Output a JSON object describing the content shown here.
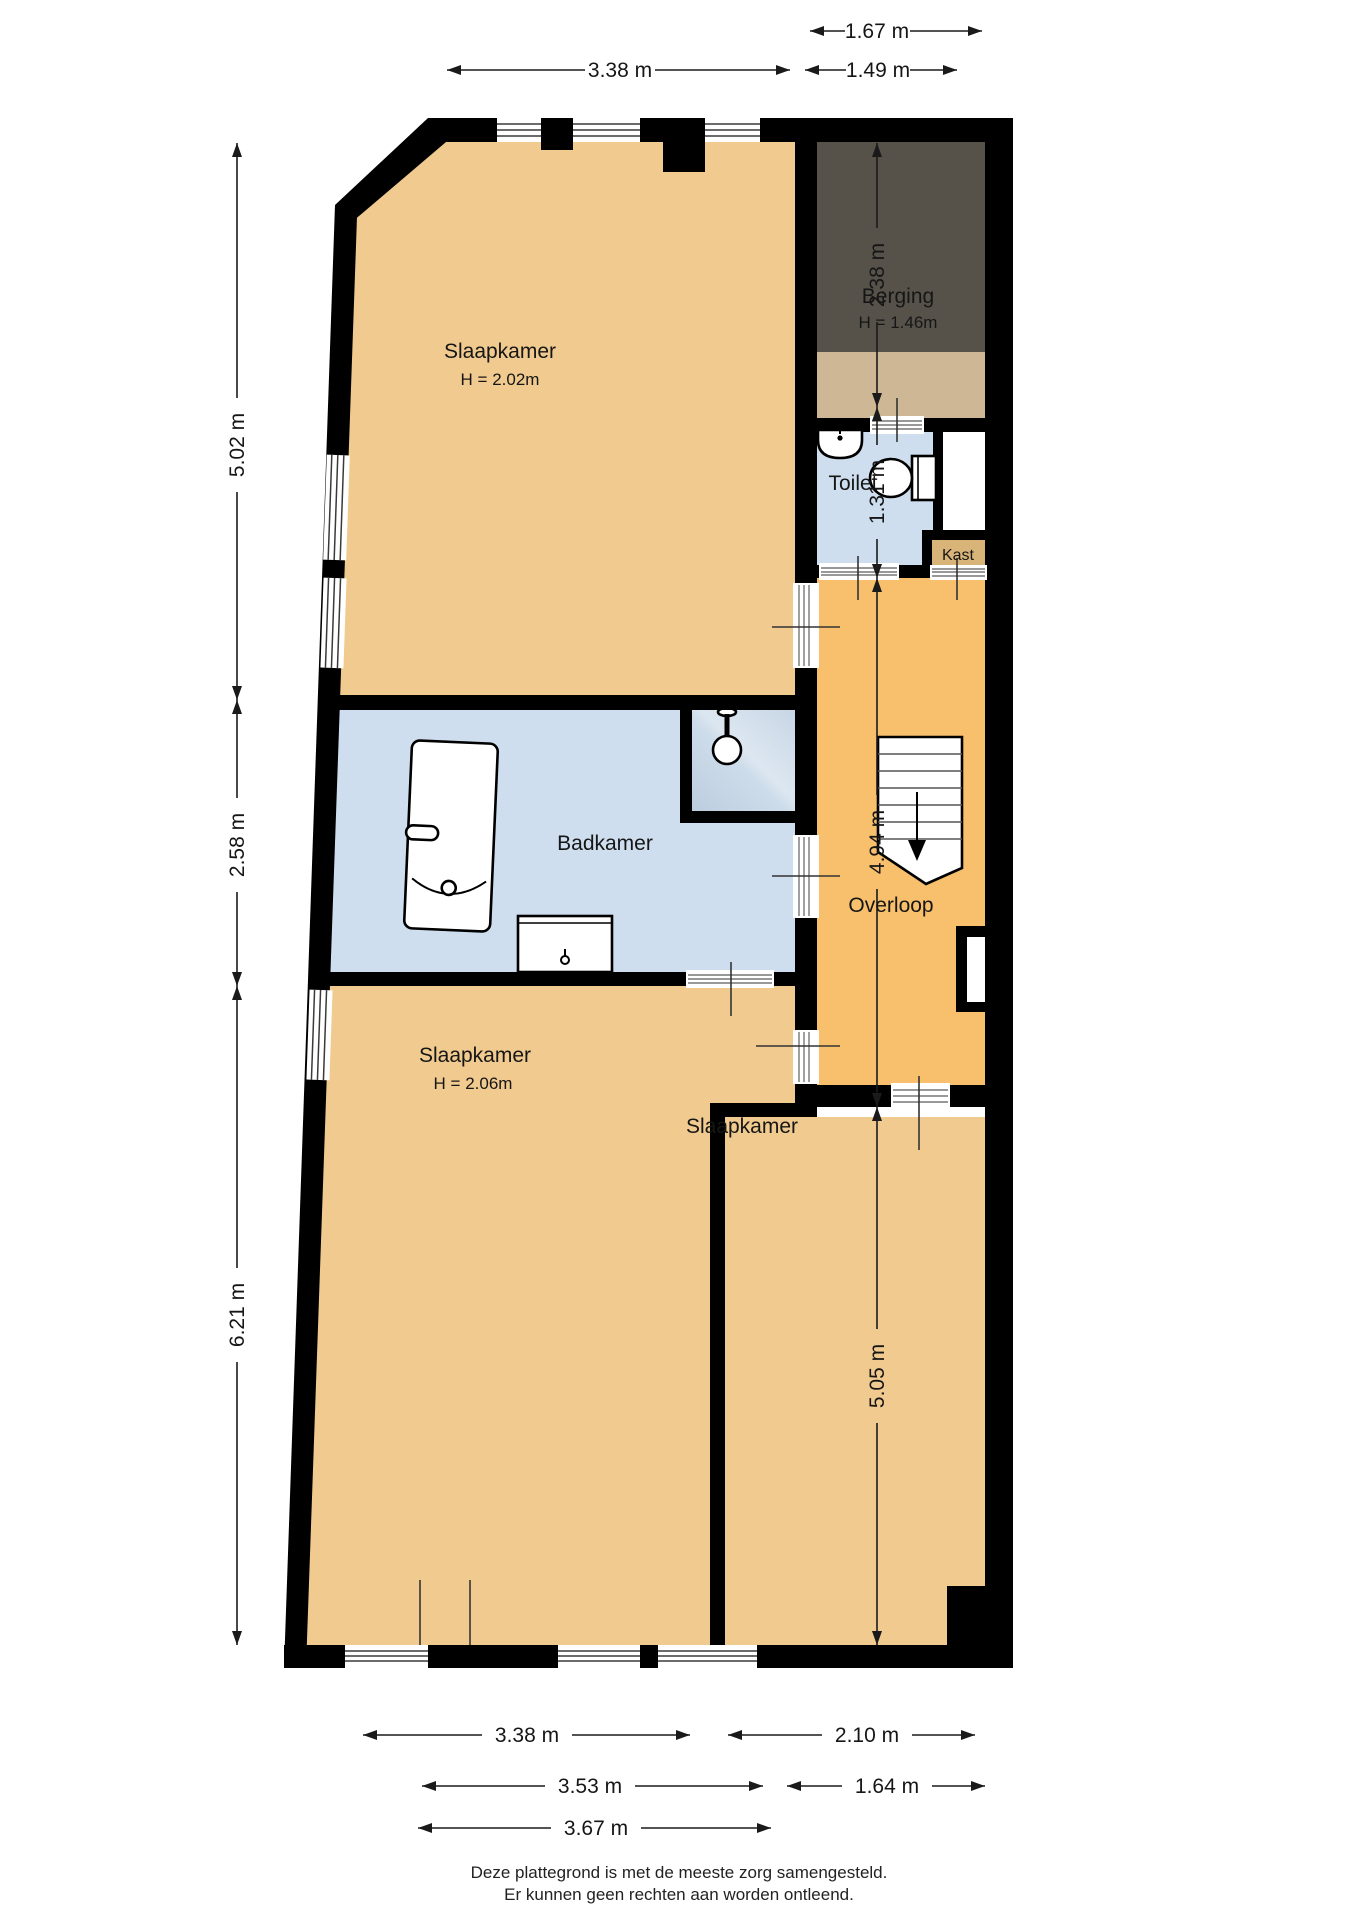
{
  "plan_title": "floor-plan",
  "rooms": [
    {
      "id": "slaapkamer-top",
      "label": "Slaapkamer",
      "height": "H = 2.02m"
    },
    {
      "id": "berging",
      "label": "Berging",
      "height": "H = 1.46m"
    },
    {
      "id": "toilet",
      "label": "Toilet"
    },
    {
      "id": "kast",
      "label": "Kast"
    },
    {
      "id": "badkamer",
      "label": "Badkamer"
    },
    {
      "id": "overloop",
      "label": "Overloop"
    },
    {
      "id": "slaapkamer-left",
      "label": "Slaapkamer",
      "height": "H = 2.06m"
    },
    {
      "id": "slaapkamer-right",
      "label": "Slaapkamer"
    }
  ],
  "dims": {
    "top": [
      "1.67 m",
      "3.38 m",
      "1.49 m"
    ],
    "left": [
      "5.02 m",
      "2.58 m",
      "6.21 m"
    ],
    "right": [
      "2.38 m",
      "1.31 m",
      "4.94 m",
      "5.05 m"
    ],
    "bottom": [
      "3.38 m",
      "2.10 m",
      "3.53 m",
      "1.64 m",
      "3.67 m"
    ]
  },
  "footer": {
    "line1": "Deze plattegrond is met de meeste zorg samengesteld.",
    "line2": "Er kunnen geen rechten aan worden ontleend."
  },
  "colors": {
    "wall": "#000000",
    "bedroom_tan": "#f0ca8e",
    "hall_orange": "#f8c06d",
    "wet_blue": "#cfdeee",
    "shower_blue": "#c2d2e3",
    "berging_dark": "#56524a",
    "berging_strip": "#cdb794",
    "kast_tan": "#d9b478"
  }
}
